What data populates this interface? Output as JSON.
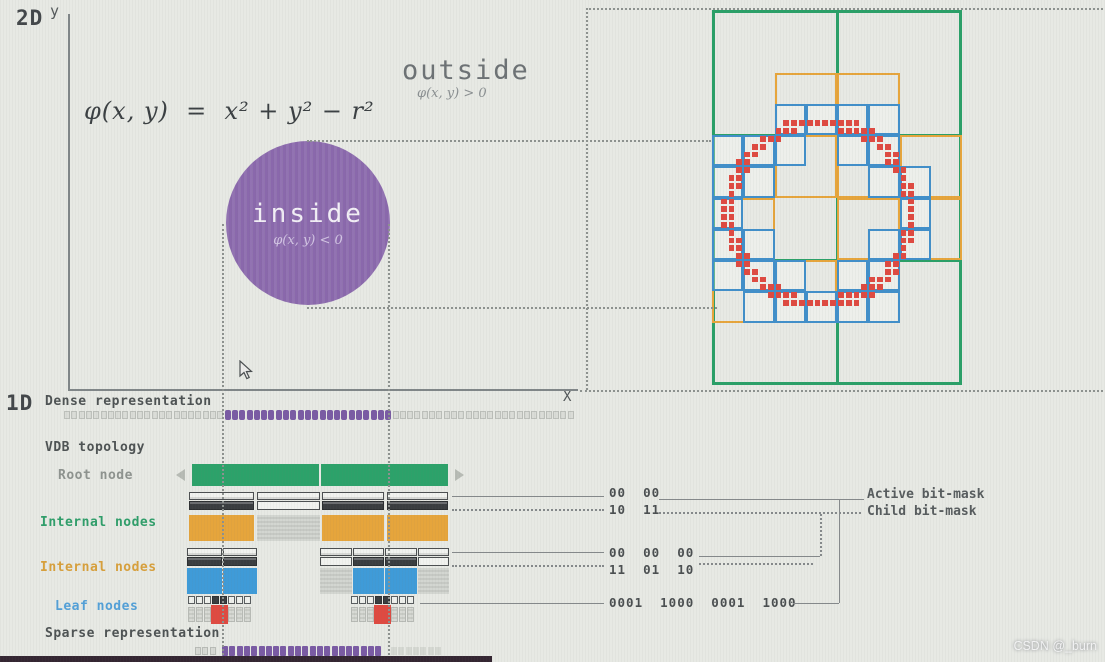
{
  "labels": {
    "dim2d": "2D",
    "dim1d": "1D",
    "y_axis": "y",
    "x_axis": "X",
    "equation": "φ(x, y)  =  x² + y² − r²",
    "outside": "outside",
    "outside_cond": "φ(x, y) > 0",
    "inside": "inside",
    "inside_cond": "φ(x, y) < 0",
    "dense": "Dense representation",
    "topology": "VDB topology",
    "root": "Root node",
    "internal1": "Internal nodes",
    "internal2": "Internal nodes",
    "leaf": "Leaf nodes",
    "sparse": "Sparse representation",
    "active_mask": "Active bit-mask",
    "child_mask": "Child bit-mask"
  },
  "masks": {
    "l1_active": "00  00",
    "l1_child": "10  11",
    "l2_active": "00  00  00",
    "l2_child": "11  01  10",
    "leaf": "0001  1000  0001  1000"
  },
  "watermark": "CSDN @_burn",
  "label_colors": {
    "root": "#8e938f",
    "internal1": "#2f9e6a",
    "internal2": "#d8a03c",
    "leaf": "#53a0d8"
  },
  "figure": {
    "axes": {
      "y": {
        "x": 68,
        "y1": 14,
        "y2": 389
      },
      "x": {
        "y": 389,
        "x1": 68,
        "x2": 578
      }
    },
    "circle2d": {
      "x": 226,
      "y": 141,
      "d": 164,
      "color": "#8a68ac"
    },
    "guides": [
      {
        "dir": "v",
        "x": 222,
        "y1": 224,
        "y2": 655
      },
      {
        "dir": "v",
        "x": 388,
        "y1": 224,
        "y2": 655
      },
      {
        "dir": "v",
        "x": 586,
        "y1": 8,
        "y2": 390
      },
      {
        "dir": "h",
        "y": 8,
        "x1": 586,
        "x2": 1103
      },
      {
        "dir": "h",
        "y": 140,
        "x1": 307,
        "x2": 711
      },
      {
        "dir": "h",
        "y": 307,
        "x1": 307,
        "x2": 717
      },
      {
        "dir": "h",
        "y": 390,
        "x1": 580,
        "x2": 1103
      }
    ],
    "quadtree": {
      "x": 712,
      "y": 10,
      "w": 250,
      "h": 375,
      "cols": 2,
      "rows": 3,
      "circle": {
        "cx": 108,
        "cy": 203,
        "r": 91,
        "t": 6.5
      },
      "orange_cells": [
        [
          1,
          1
        ],
        [
          2,
          1
        ],
        [
          0,
          2
        ],
        [
          1,
          2
        ],
        [
          2,
          2
        ],
        [
          3,
          2
        ],
        [
          0,
          3
        ],
        [
          2,
          3
        ],
        [
          3,
          3
        ],
        [
          0,
          4
        ],
        [
          1,
          4
        ],
        [
          2,
          4
        ]
      ],
      "colors": {
        "green": "#2aa068",
        "orange": "#e6a53c",
        "blue": "#418fca",
        "red": "#df4a41"
      }
    },
    "dense_strip": {
      "x1": 64,
      "x2": 580,
      "y": 410,
      "h": 10,
      "cell": 7.3,
      "purple_x1": 222,
      "purple_x2": 389,
      "purple": "#7a5ba4"
    },
    "sparse_strip": {
      "y": 646,
      "h": 10,
      "cell": 7.3,
      "purple": "#7a5ba4",
      "runs": [
        {
          "x1": 195,
          "x2": 219,
          "type": "gray"
        },
        {
          "x1": 222,
          "x2": 386,
          "type": "purple"
        },
        {
          "x1": 391,
          "x2": 443,
          "type": "faint"
        }
      ]
    },
    "root_bar": {
      "x": 192,
      "y": 464,
      "w": 256,
      "h": 22,
      "split": 128,
      "color": "#2ca26a"
    },
    "level1": {
      "mask_y": 492,
      "bar_y": 515,
      "bar_h": 26,
      "bar_color": "#e6a53c",
      "slots": [
        {
          "x": 189,
          "w": 65,
          "child": 1
        },
        {
          "x": 257,
          "w": 63,
          "child": 0
        },
        {
          "x": 322,
          "w": 62,
          "child": 1
        },
        {
          "x": 387,
          "w": 61,
          "child": 1
        }
      ]
    },
    "level2": {
      "mask_y": 548,
      "bar_y": 568,
      "bar_h": 26,
      "bar_color": "#3f9bd8",
      "slots": [
        {
          "x": 187,
          "w": 35,
          "child": 1
        },
        {
          "x": 223,
          "w": 34,
          "child": 1
        },
        {
          "x": 320,
          "w": 32,
          "child": 0
        },
        {
          "x": 353,
          "w": 31,
          "child": 1
        },
        {
          "x": 385,
          "w": 32,
          "child": 1
        },
        {
          "x": 418,
          "w": 31,
          "child": 0
        }
      ]
    },
    "leaves": {
      "mask_y": 596,
      "val_y": 607,
      "val_h": 15,
      "cell": 8,
      "red": "#df4a41",
      "groups": [
        {
          "x": 188,
          "bits": [
            0,
            0,
            0,
            1,
            1,
            0,
            0,
            0
          ]
        },
        {
          "x": 351,
          "bits": [
            0,
            0,
            0,
            1,
            1,
            0,
            0,
            0
          ]
        }
      ]
    },
    "connectors": [
      {
        "dir": "h",
        "x1": 452,
        "y1": 496,
        "x2": 604,
        "style": "solid"
      },
      {
        "dir": "h",
        "x1": 452,
        "y1": 509,
        "x2": 604,
        "style": "dotted"
      },
      {
        "dir": "h",
        "x1": 659,
        "y1": 499,
        "x2": 864,
        "style": "solid"
      },
      {
        "dir": "h",
        "x1": 659,
        "y1": 512,
        "x2": 861,
        "style": "dotted"
      },
      {
        "dir": "h",
        "x1": 452,
        "y1": 552,
        "x2": 604,
        "style": "solid"
      },
      {
        "dir": "h",
        "x1": 452,
        "y1": 565,
        "x2": 604,
        "style": "dotted"
      },
      {
        "dir": "h",
        "x1": 699,
        "y1": 556,
        "x2": 820,
        "style": "solid"
      },
      {
        "dir": "h",
        "x1": 699,
        "y1": 563,
        "x2": 813,
        "style": "dotted"
      },
      {
        "dir": "v",
        "x1": 820,
        "y1": 514,
        "y2": 556,
        "style": "dotted"
      },
      {
        "dir": "h",
        "x1": 420,
        "y1": 603,
        "x2": 604,
        "style": "solid"
      },
      {
        "dir": "h",
        "x1": 793,
        "y1": 603,
        "x2": 839,
        "style": "solid"
      },
      {
        "dir": "v",
        "x1": 839,
        "y1": 499,
        "y2": 603,
        "style": "solid"
      }
    ]
  }
}
